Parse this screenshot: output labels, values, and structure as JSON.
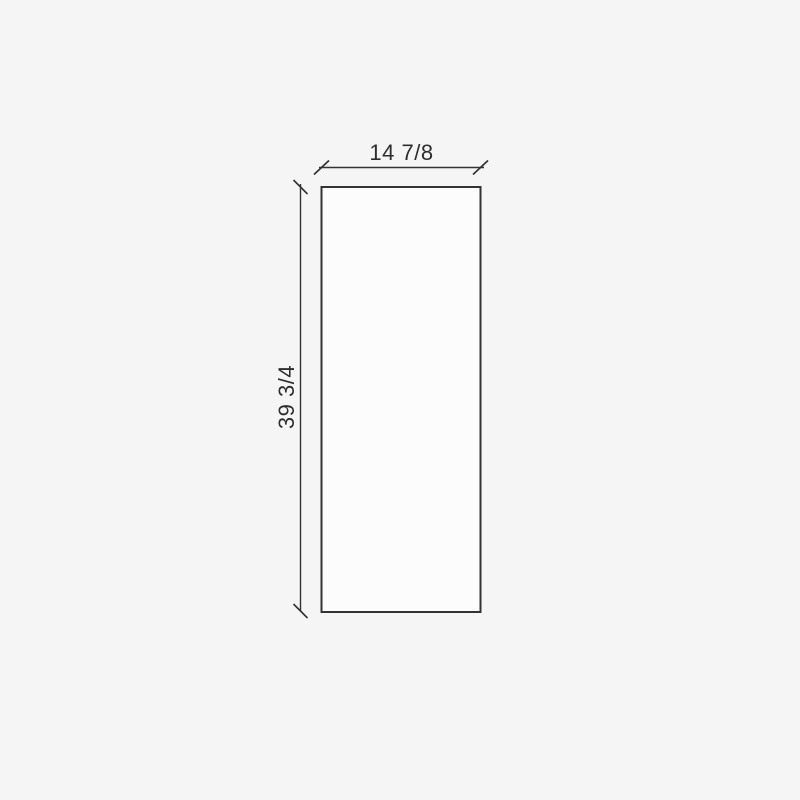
{
  "drawing": {
    "type": "panel-dimension-drawing",
    "width_label": "14 7/8",
    "height_label": "39 3/4",
    "colors": {
      "background": "#f5f5f5",
      "panel_fill": "#fcfcfc",
      "line": "#333333",
      "text": "#2e2e2e"
    }
  }
}
